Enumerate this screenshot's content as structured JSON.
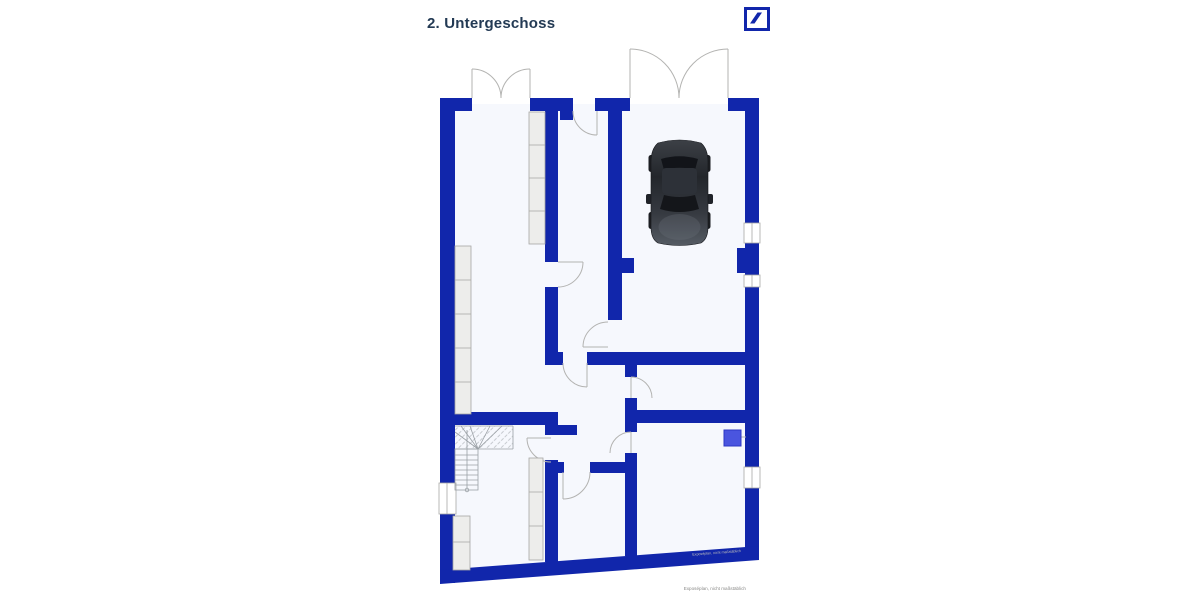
{
  "colors": {
    "wall-color": "#1126ab",
    "room-fill": "#f6f8fd",
    "line-color": "#b3b3b1",
    "window-line": "#a8a8a6",
    "shelf-fill": "#ededeb",
    "shelf-stroke": "#a6a6a4",
    "stair-line": "#9aa0a5",
    "appliance-fill": "#4a55df",
    "appliance-stroke": "#2c38c4",
    "title-color": "#233a54",
    "annotation-color": "#8a8a88",
    "watermark-color": "#bdbdbb",
    "logo-color": "#1126ab",
    "car-dark": "#17191d",
    "car-body": "#2e3238"
  },
  "header": {
    "title": "2. Untergeschoss"
  },
  "logo": {
    "name": "deutsche-bank-logo"
  },
  "plan": {
    "floor_label": "2. Untergeschoss",
    "annotation": "Exposéplan, nicht maßstäblich",
    "watermark": "Exposéplan, nicht maßstäblich",
    "elements": {
      "car": "parked car seen from above in garage",
      "staircase": "winder staircase with hatched upper run",
      "shelves": "built-in shelving / storage strips",
      "appliance": "blue boiler box connected to right wall",
      "double-doors": "two outward-swinging double entry doors at top",
      "windows": "windows in left and right outer walls"
    }
  }
}
